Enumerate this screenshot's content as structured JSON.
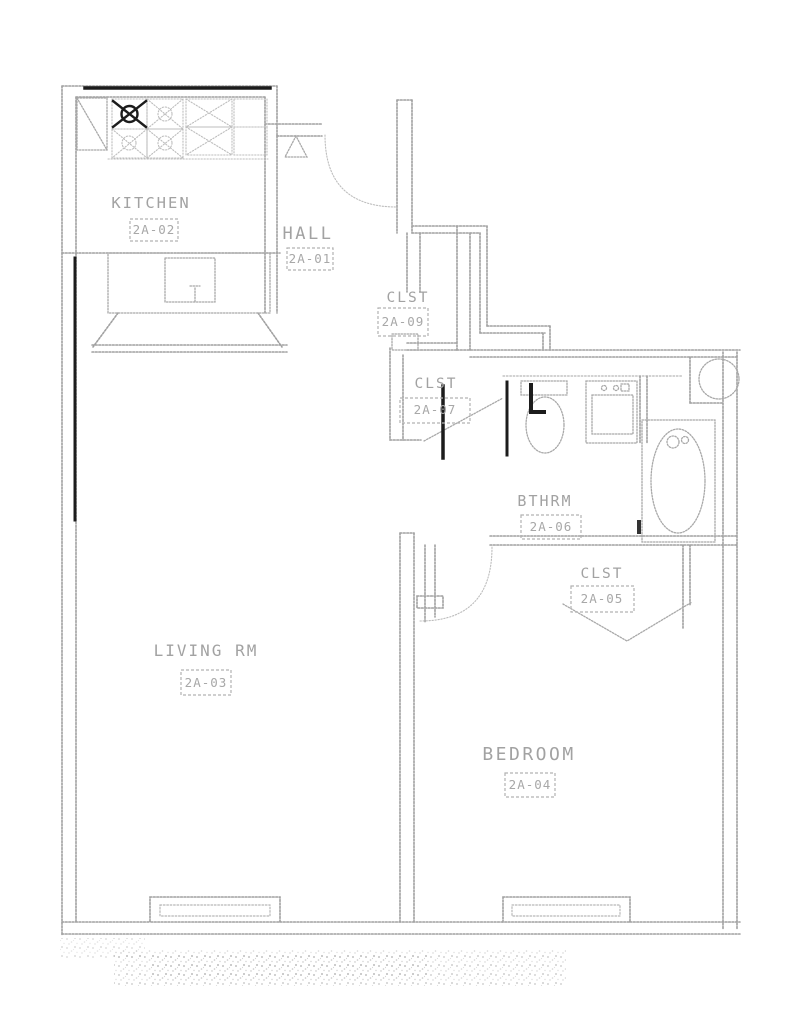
{
  "plan": {
    "rooms": {
      "kitchen": {
        "label": "KITCHEN",
        "tag": "2A-02"
      },
      "hall": {
        "label": "HALL",
        "tag": "2A-01"
      },
      "hall_closet": {
        "label": "CLST",
        "tag": "2A-09"
      },
      "linen_closet": {
        "label": "CLST",
        "tag": "2A-07"
      },
      "bathroom": {
        "label": "BTHRM",
        "tag": "2A-06"
      },
      "bedroom_closet": {
        "label": "CLST",
        "tag": "2A-05"
      },
      "living_room": {
        "label": "LIVING RM",
        "tag": "2A-03"
      },
      "bedroom": {
        "label": "BEDROOM",
        "tag": "2A-04"
      }
    },
    "fixtures": [
      "refrigerator",
      "range-burners",
      "kitchen-counter-sink",
      "toilet",
      "vanity-sink",
      "bathtub",
      "column",
      "entry-door-swing",
      "bedroom-door-swing",
      "bathroom-door-leaf",
      "closet-bifold-doors",
      "living-room-window",
      "bedroom-window",
      "revision-triangle"
    ],
    "colors": {
      "paper": "#ffffff",
      "line": "#a0a0a0",
      "line_faint": "#bdbdbd",
      "ink_dark": "#1c1c1c",
      "text": "#a2a2a2"
    }
  }
}
